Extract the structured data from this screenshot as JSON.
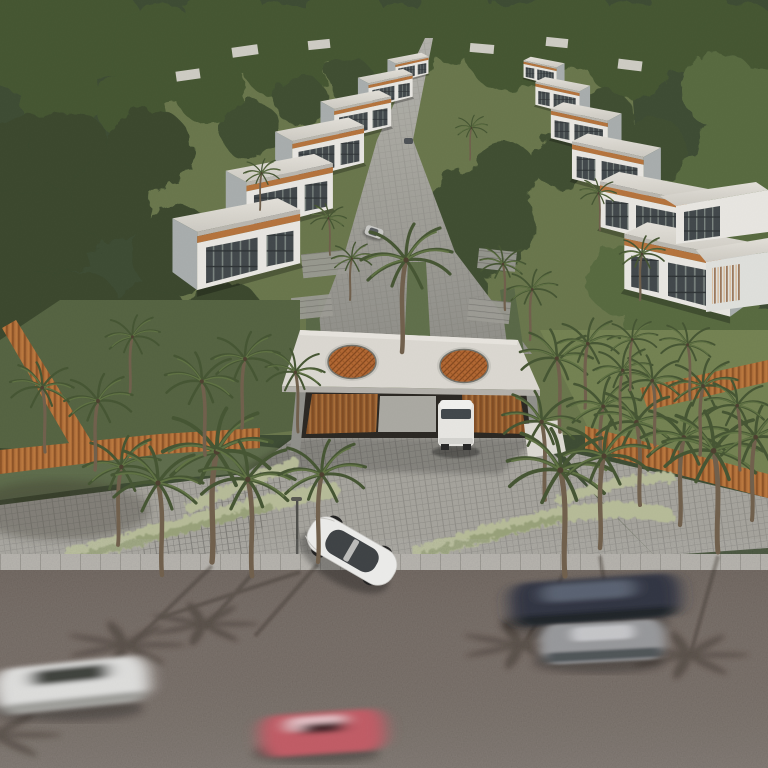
{
  "scene": {
    "type": "architectural-aerial-render",
    "subject": "Gated villa community with palm trees, twin-skylight entrance canopy and passing traffic",
    "entrance": {
      "canopy_skylights": 2,
      "gatehouse_panels": "wood slat",
      "security_van": "white"
    },
    "villas": {
      "left_row": 6,
      "right_row": 6,
      "right_edge": 2
    },
    "vehicles": {
      "entering_car": "white sedan",
      "internal_cars": [
        "silver hatchback",
        "dark car"
      ],
      "blurred_road_cars": [
        "white sedan",
        "dark blue sedan",
        "gray sedan",
        "red sedan"
      ]
    },
    "vegetation": {
      "palms": "many",
      "forest": "dense canopy surrounding site",
      "ornamental_grass": "sage beds at driveway"
    }
  },
  "colors": {
    "forest_base": "#3b4930",
    "lawn_dark": "#52613f",
    "lawn_mid": "#677549",
    "lawn_light": "#71804f",
    "pavers": "#a4a29b",
    "pavers_dark": "#94938b",
    "curb": "#b2afa8",
    "asphalt": "#6c615a",
    "gate_roof": "#dbd8d1",
    "skylight": "#b2652f",
    "wood_fence": "#ad6a34",
    "grass_sage": "#b6bb97",
    "van_white": "#e8e7e2",
    "sedan_white": "#ececea",
    "car_blue": "#2d3340",
    "car_white": "#dddddb",
    "car_gray": "#96979a",
    "car_red": "#c05a64",
    "villa_wall": "#e9e7e1",
    "villa_glass": "#3f4548",
    "villa_wood": "#b5713a",
    "palm_frond": "#42522f",
    "palm_trunk": "#6e5d49",
    "shadow": "#3a3129"
  }
}
